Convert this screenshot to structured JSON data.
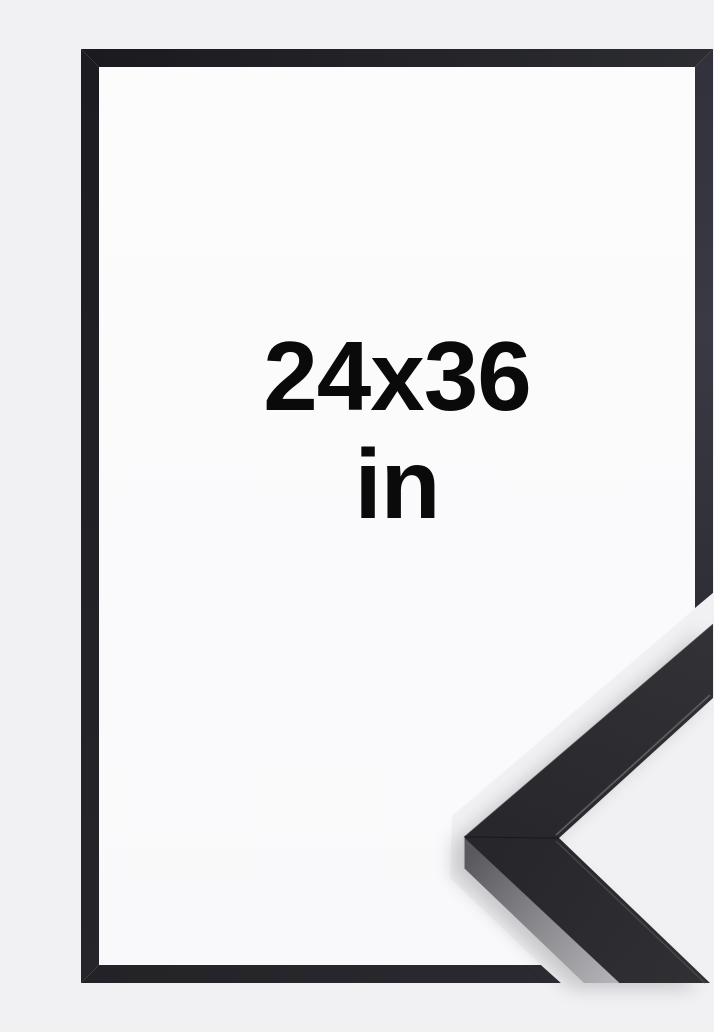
{
  "page": {
    "background_color": "#f1f1f3",
    "description": "Product image of a black picture frame with size label and a close-up corner of the frame moulding profile"
  },
  "size_label": {
    "dimensions": "24x36",
    "unit": "in",
    "text_color": "#0a0a0a"
  },
  "frame": {
    "color_name": "black",
    "interior_color": "#fbfbfc",
    "border_top_color": "#1f1f25",
    "border_left_color": "#202026",
    "border_right_color": "#34343e",
    "border_bottom_color": "#26262c"
  },
  "corner_detail": {
    "top_surface_color": "#2b2b2f",
    "side_face_light_color": "#b4b4b8",
    "side_face_dark_color": "#59595e",
    "miter_seam_color": "#17171a",
    "lip_highlight_color": "#5d5d63"
  }
}
